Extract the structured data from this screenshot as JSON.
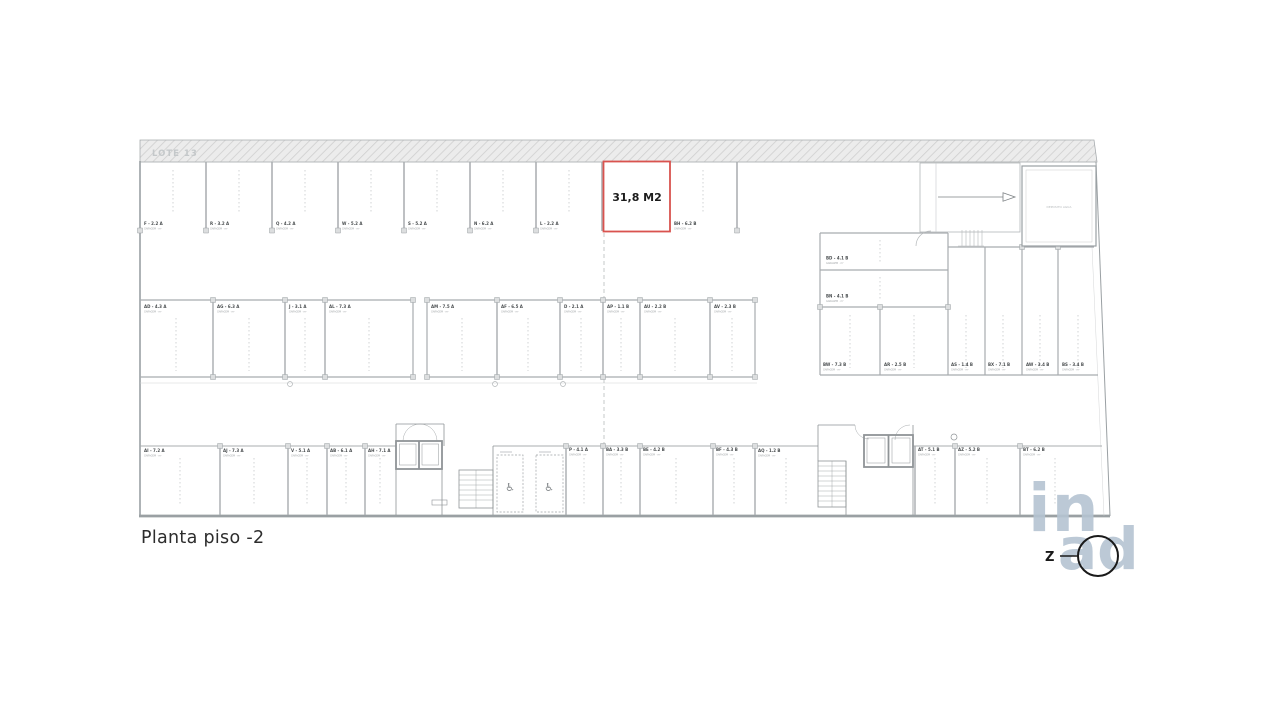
{
  "title": "Planta piso -2",
  "plan": {
    "lote_label": "LOTE 13",
    "highlight_area": "31,8 M2",
    "highlight_color": "#d9534f",
    "garage_sublabel": "GARAGEM · m²",
    "deposit_room": "DEPOSITO AGUA",
    "compass_letter": "Z"
  },
  "watermark": {
    "top": "in",
    "bottom": "ad"
  },
  "spaces": {
    "top_row": [
      "F - 2.2 A",
      "R - 3.2 A",
      "Q - 4.2 A",
      "W - 5.2 A",
      "S - 5.2 A",
      "N - 6.2 A",
      "L - 2.2 A",
      "BH - 6.2 B"
    ],
    "middle_row": [
      "AD - 4.3 A",
      "AG - 6.3 A",
      "J - 3.1 A",
      "AL - 7.3 A",
      "AM - 7.5 A",
      "AF - 6.5 A",
      "D - 2.1 A",
      "AP - 1.1 B",
      "AU - 2.2 B",
      "AV - 2.3 B"
    ],
    "right_block_horizontal": [
      "BD - 4.1 B",
      "BN - 4.1 B"
    ],
    "right_block_vertical": [
      "BW - 7.3 B",
      "AR - 2.5 B",
      "AS - 1.4 B",
      "BX - 7.1 B",
      "AW - 3.4 B",
      "BS - 3.4 B"
    ],
    "bottom_row": [
      "AI - 7.2 A",
      "AJ - 7.3 A",
      "V - 5.1 A",
      "AB - 6.1 A",
      "AH - 7.1 A",
      "P - 4.1 A",
      "BA - 3.3 B",
      "BE - 4.2 B",
      "BF - 4.3 B",
      "AQ - 1.2 B",
      "AT - 5.1 B",
      "AZ - 5.2 B",
      "BT - 6.2 B"
    ]
  }
}
